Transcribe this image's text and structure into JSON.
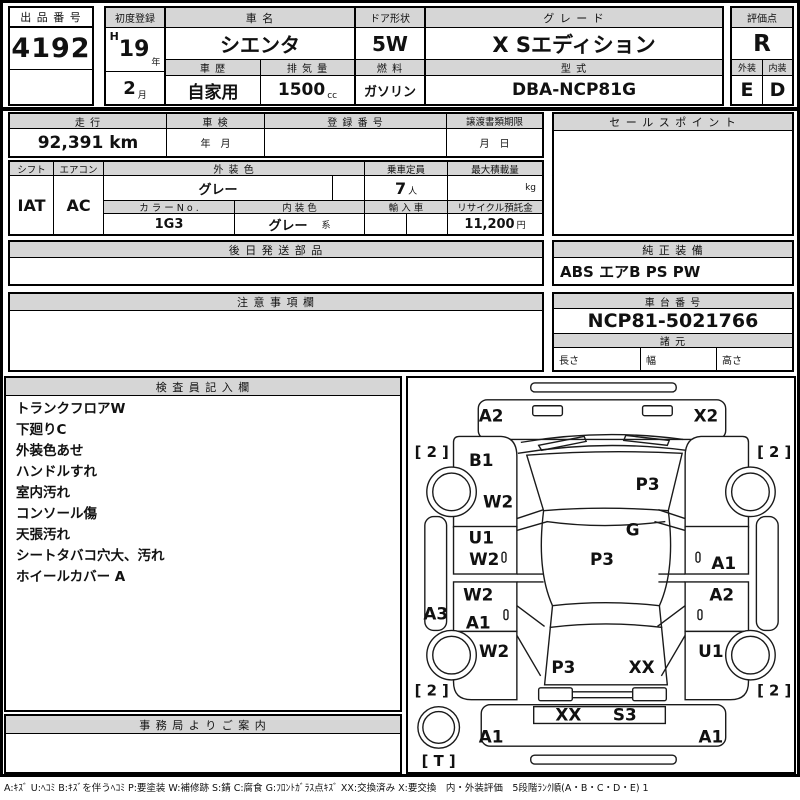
{
  "top": {
    "auction_no_label": "出 品 番 号",
    "auction_no": "4192",
    "first_reg_label": "初度登録",
    "era": "H",
    "reg_year": "19",
    "year_suffix": "年",
    "reg_month": "2",
    "month_suffix": "月",
    "car_name_label": "車 名",
    "car_name": "シエンタ",
    "history_label": "車 歴",
    "history": "自家用",
    "disp_label": "排 気 量",
    "disp": "1500",
    "disp_unit": "cc",
    "door_label": "ドア形状",
    "door": "5W",
    "fuel_label": "燃 料",
    "fuel": "ガソリン",
    "grade_label": "グ レ ー ド",
    "grade": "X Sエディション",
    "model_label": "型 式",
    "model": "DBA-NCP81G",
    "score_label": "評価点",
    "score": "R",
    "ext_label": "外装",
    "ext": "E",
    "int_label": "内装",
    "int": "D"
  },
  "specs": {
    "mileage_label": "走 行",
    "mileage": "92,391 km",
    "inspection_label": "車 検",
    "inspection": "年　月",
    "reg_no_label": "登 録 番 号",
    "transfer_label": "譲渡書類期限",
    "transfer": "月　日",
    "shift_label": "シフト",
    "shift": "IAT",
    "ac_label": "エアコン",
    "ac": "AC",
    "ext_color_label": "外 装 色",
    "ext_color": "グレー",
    "color_no_label": "カ ラ ー N o .",
    "color_no": "1G3",
    "int_color_label": "内 装 色",
    "int_color": "グレー",
    "int_color_suffix": "系",
    "capacity_label": "乗車定員",
    "capacity": "7",
    "capacity_unit": "人",
    "import_label": "輸 入 車",
    "max_load_label": "最大積載量",
    "max_load_unit": "kg",
    "recycle_label": "リサイクル預託金",
    "recycle": "11,200",
    "recycle_unit": "円"
  },
  "sales_point_label": "セ ー ル ス ポ イ ン ト",
  "later_parts_label": "後 日 発 送 部 品",
  "equipment_label": "純 正 装 備",
  "equipment": "ABS エアB PS PW",
  "caution_label": "注 意 事 項 欄",
  "chassis_label": "車 台 番 号",
  "chassis_no": "NCP81-5021766",
  "dimensions_label": "諸 元",
  "length_label": "長さ",
  "width_label": "幅",
  "height_label": "高さ",
  "inspector": {
    "label": "検 査 員 記 入 欄",
    "notes": [
      "トランクフロアW",
      "下廻りC",
      "外装色あせ",
      "ハンドルすれ",
      "室内汚れ",
      "コンソール傷",
      "天張汚れ",
      "シートタバコ穴大、汚れ",
      "ホイールカバー A"
    ]
  },
  "office_label": "事 務 局 よ り ご 案 内",
  "legend": "A:ｷｽﾞ U:ﾍｺﾐ B:ｷｽﾞを伴うﾍｺﾐ P:要塗装 W:補修跡 S:錆 C:腐食 G:ﾌﾛﾝﾄｶﾞﾗｽ点ｷｽﾞ XX:交換済み X:要交換　内・外装評価　5段階ﾗﾝｸ順(A・B・C・D・E) 1",
  "diagram": {
    "front_bumper_left": "A2",
    "front_bumper_right": "X2",
    "left_front_fender": "B1",
    "left_front_fender_2": "W2",
    "windshield": "P3",
    "cowl": "G",
    "roof": "P3",
    "left_front_door_1": "U1",
    "left_front_door_2": "W2",
    "left_rear_door_1": "W2",
    "left_rear_door_2": "A1",
    "left_rocker": "A3",
    "right_front_door": "A1",
    "right_rear_door": "A2",
    "left_rear_fender": "W2",
    "right_rear_fender": "U1",
    "rear_window_left": "P3",
    "rear_window_right": "XX",
    "hatch_left": "XX",
    "hatch_right": "S3",
    "rear_bumper_left": "A1",
    "rear_bumper_right": "A1",
    "tire_front_left": "[ 2 ]",
    "tire_front_right": "[ 2 ]",
    "tire_rear_left": "[ 2 ]",
    "tire_rear_right": "[ 2 ]",
    "spare_tire": "[ T ]"
  }
}
